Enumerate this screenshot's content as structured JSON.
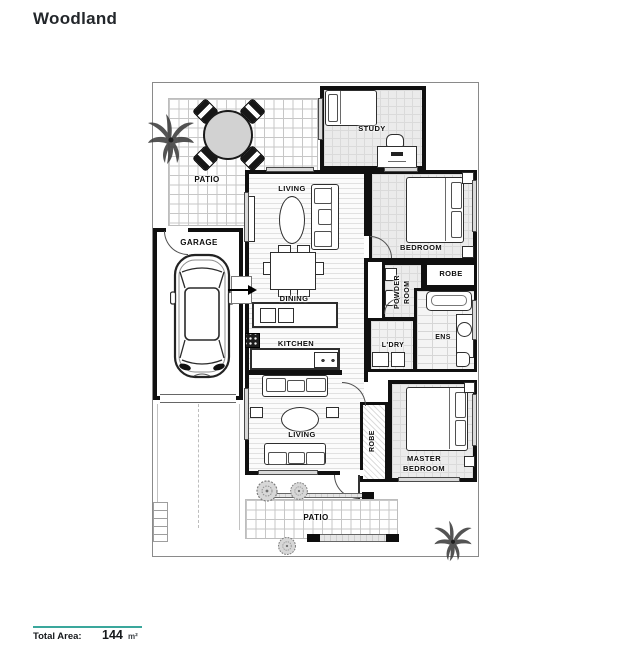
{
  "title": "Woodland",
  "plan": {
    "labels": {
      "patio_top": "PATIO",
      "study": "STUDY",
      "living_front": "LIVING",
      "bedroom": "BEDROOM",
      "garage": "GARAGE",
      "dining": "DINING",
      "robe_upper": "ROBE",
      "powder_line1": "POWDER",
      "powder_line2": "ROOM",
      "kitchen": "KITCHEN",
      "laundry": "L'DRY",
      "ensuite": "ENS",
      "living_rear": "LIVING",
      "robe_master": "ROBE",
      "master_line1": "MASTER",
      "master_line2": "BEDROOM",
      "patio_bottom": "PATIO"
    }
  },
  "footer": {
    "label": "Total Area:",
    "value": "144",
    "unit": "m²"
  },
  "colors": {
    "accent": "#3aa79c",
    "wall": "#101010",
    "floor_gray": "#ebebeb"
  }
}
